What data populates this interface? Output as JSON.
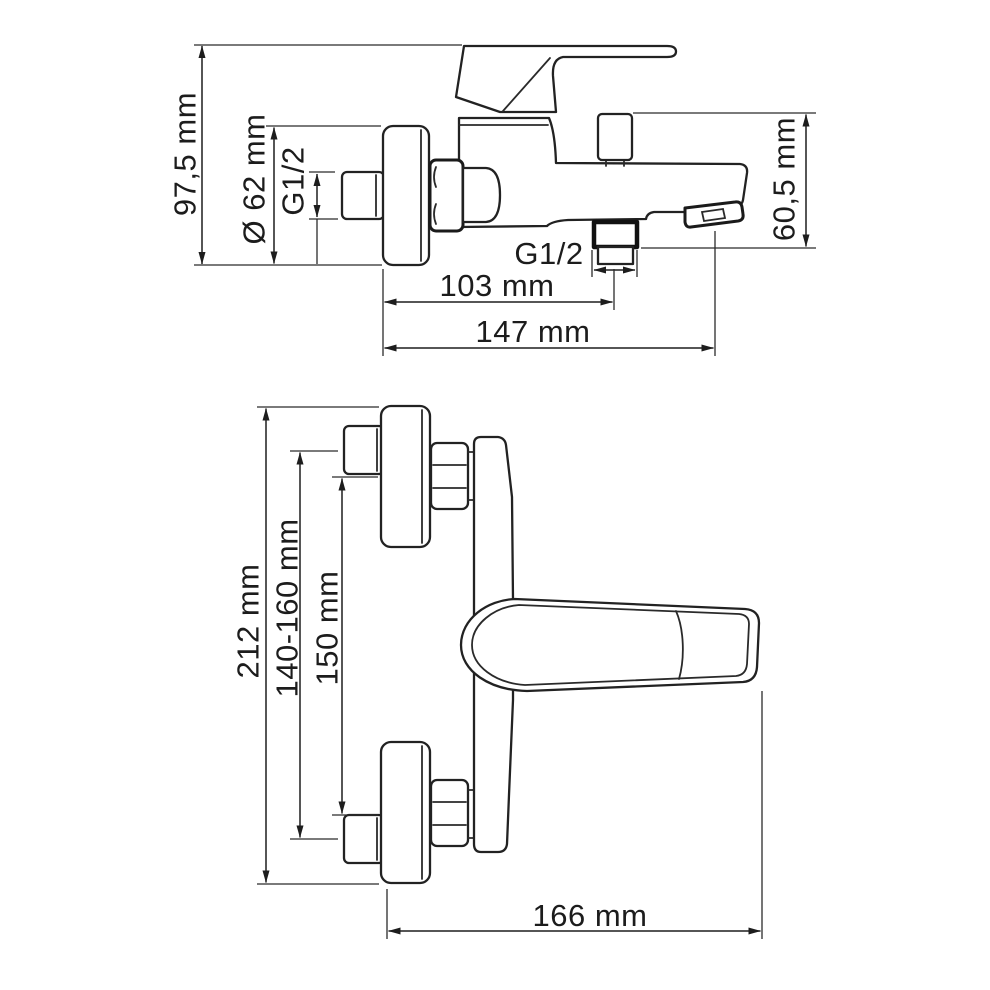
{
  "colors": {
    "ink": "#1f1f1f",
    "background": "#ffffff",
    "bold_line": "#111111"
  },
  "views": {
    "plan": {
      "dimensions": [
        {
          "id": "overall-depth",
          "label": "97,5 mm",
          "orientation": "vertical"
        },
        {
          "id": "escutcheon-diameter",
          "label": "Ø 62 mm",
          "orientation": "vertical"
        },
        {
          "id": "wall-inlet-thread",
          "label": "G1/2",
          "orientation": "vertical"
        },
        {
          "id": "shower-outlet-thread",
          "label": "G1/2",
          "orientation": "horizontal"
        },
        {
          "id": "wall-to-shower-outlet",
          "label": "103 mm",
          "orientation": "horizontal"
        },
        {
          "id": "spout-reach",
          "label": "147 mm",
          "orientation": "horizontal"
        },
        {
          "id": "spout-drop-height",
          "label": "60,5 mm",
          "orientation": "vertical"
        }
      ]
    },
    "elevation": {
      "dimensions": [
        {
          "id": "overall-height",
          "label": "212 mm",
          "orientation": "vertical"
        },
        {
          "id": "mounting-centers-range",
          "label": "140-160 mm",
          "orientation": "vertical"
        },
        {
          "id": "connection-centers",
          "label": "150 mm",
          "orientation": "vertical"
        },
        {
          "id": "overall-width",
          "label": "166 mm",
          "orientation": "horizontal"
        }
      ]
    }
  }
}
